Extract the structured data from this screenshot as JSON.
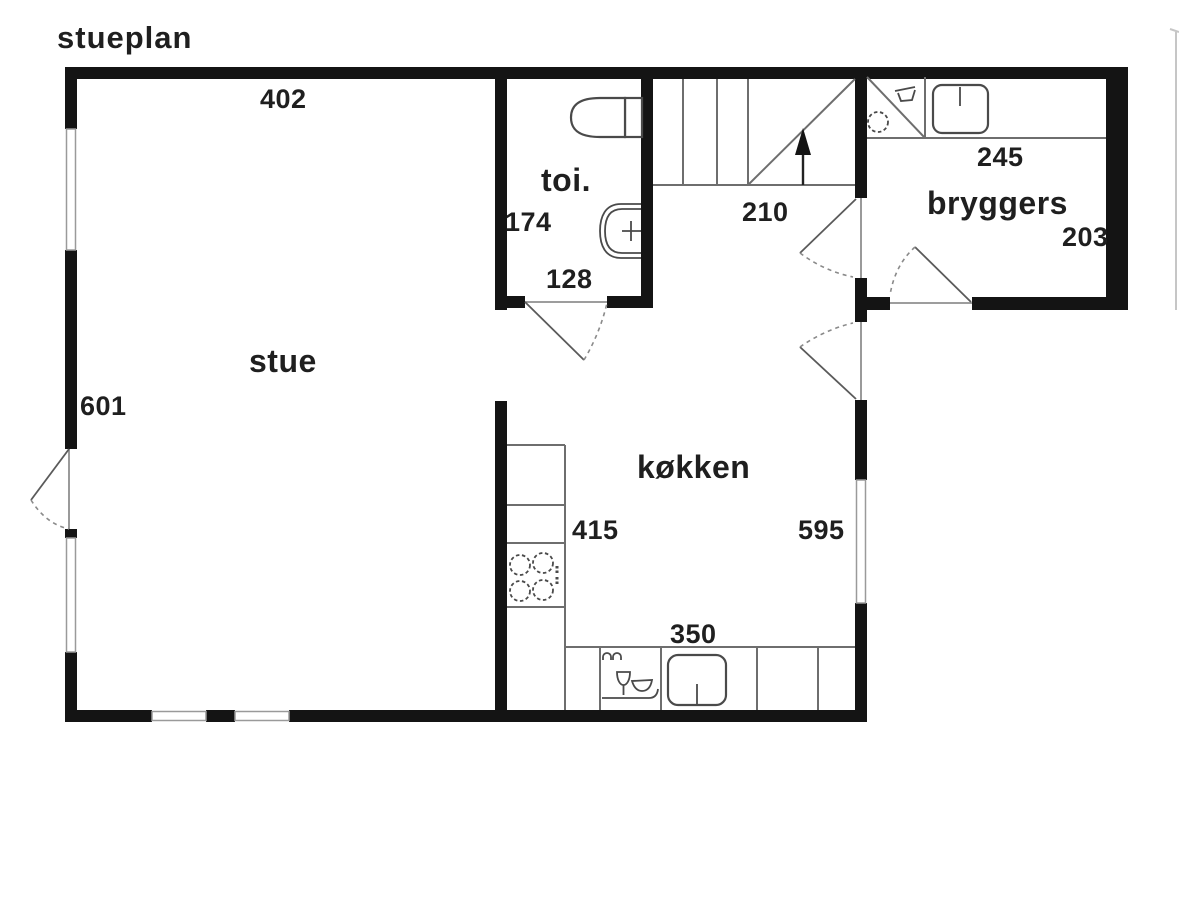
{
  "title": "stueplan",
  "rooms": {
    "stue": {
      "label": "stue",
      "top_width": "402",
      "left_height": "601"
    },
    "toilet": {
      "label": "toi.",
      "left_height": "174",
      "bottom_width": "128"
    },
    "stairs": {
      "bottom_width": "210"
    },
    "bryggers": {
      "label": "bryggers",
      "top_width": "245",
      "right_height": "203"
    },
    "kitchen": {
      "label": "køkken",
      "upper_width": "415",
      "right_height": "595",
      "bottom_width": "350"
    }
  },
  "fixtures": [
    "toilet-icon",
    "hand-basin-icon",
    "stairs-up-arrow-icon",
    "washing-machine-icon",
    "laundry-sink-icon",
    "utility-sink-icon",
    "cooktop-icon",
    "dishwasher-icon",
    "kitchen-sink-icon"
  ],
  "doors": [
    "entry-door-left",
    "toilet-door",
    "hall-bryggers-door",
    "kitchen-back-door",
    "bryggers-exterior-door"
  ],
  "colors": {
    "wall": "#141414",
    "thin_line": "#6e6e6e",
    "fixture_line": "#4a4a4a",
    "dashed_line": "#8a8a8a",
    "window_line": "#9a9a9a",
    "text": "#1f1f1f",
    "background": "#ffffff",
    "edge_artifact": "#c6c6c6"
  }
}
